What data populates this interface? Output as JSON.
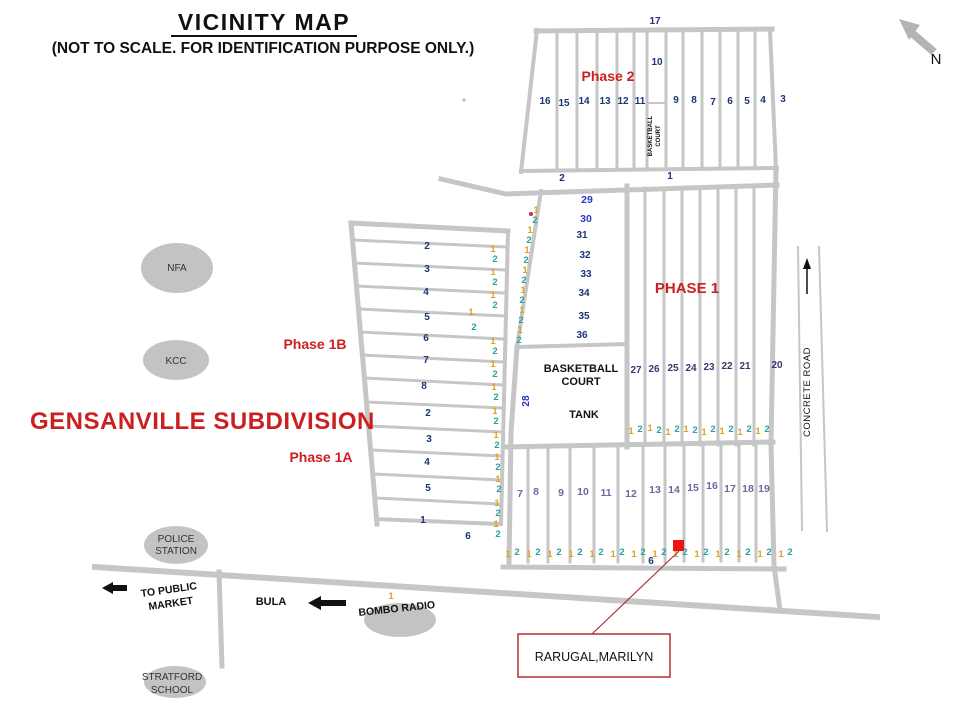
{
  "title": "VICINITY MAP",
  "subtitle": "(NOT TO SCALE. FOR IDENTIFICATION PURPOSE ONLY.)",
  "subdivision": "GENSANVILLE SUBDIVISION",
  "compass": {
    "north": "N"
  },
  "phases": {
    "phase2": "Phase 2",
    "phase1": "PHASE 1",
    "phase1b": "Phase 1B",
    "phase1a": "Phase 1A"
  },
  "landmarks": {
    "nfa": "NFA",
    "kcc": "KCC",
    "police_line1": "POLICE",
    "police_line2": "STATION",
    "stratford_line1": "STRATFORD",
    "stratford_line2": "SCHOOL",
    "bombo_radio": "BOMBO RADIO"
  },
  "roads": {
    "concrete_road": "CONCRETE ROAD",
    "bula": "BULA",
    "to_public_market_line1": "TO PUBLIC",
    "to_public_market_line2": "MARKET"
  },
  "facilities": {
    "bb_small_line1": "BASKETBALL",
    "bb_small_line2": "COURT",
    "bb_line1": "BASKETBALL",
    "bb_line2": "COURT",
    "tank": "TANK",
    "lot28": "28"
  },
  "highlight": {
    "owner": "RARUGAL,MARILYN"
  },
  "colors": {
    "road_gray": "#c6c6c6",
    "lot_navy": "#1c3577",
    "lot_blue": "#2a35cc",
    "lot_slate": "#6a6a9c",
    "lot_dark_navy": "#38386e",
    "lot_orange": "#e2a221",
    "lot_teal": "#2f9fa0",
    "label_red": "#cc2020",
    "marker_red": "#ee1212"
  },
  "markers": {
    "phase2": [
      {
        "t": "17",
        "x": 655,
        "y": 24,
        "c": "n-nv"
      },
      {
        "t": "10",
        "x": 657,
        "y": 65,
        "c": "n-nv"
      },
      {
        "t": "16",
        "x": 545,
        "y": 104,
        "c": "n-nv"
      },
      {
        "t": "15",
        "x": 564,
        "y": 106,
        "c": "n-nv"
      },
      {
        "t": "14",
        "x": 584,
        "y": 104,
        "c": "n-nv"
      },
      {
        "t": "13",
        "x": 605,
        "y": 104,
        "c": "n-nv"
      },
      {
        "t": "12",
        "x": 623,
        "y": 104,
        "c": "n-nv"
      },
      {
        "t": "11",
        "x": 640,
        "y": 104,
        "c": "n-nv"
      },
      {
        "t": "9",
        "x": 676,
        "y": 103,
        "c": "n-nv"
      },
      {
        "t": "8",
        "x": 694,
        "y": 103,
        "c": "n-nv"
      },
      {
        "t": "7",
        "x": 713,
        "y": 105,
        "c": "n-nv"
      },
      {
        "t": "6",
        "x": 730,
        "y": 104,
        "c": "n-nv"
      },
      {
        "t": "5",
        "x": 747,
        "y": 104,
        "c": "n-nv"
      },
      {
        "t": "4",
        "x": 763,
        "y": 103,
        "c": "n-nv"
      },
      {
        "t": "3",
        "x": 783,
        "y": 102,
        "c": "n-nv"
      },
      {
        "t": "2",
        "x": 562,
        "y": 181,
        "c": "n-nv"
      },
      {
        "t": "1",
        "x": 670,
        "y": 179,
        "c": "n-nv"
      }
    ],
    "block2936": [
      {
        "t": "29",
        "x": 587,
        "y": 203,
        "c": "n-bl"
      },
      {
        "t": "30",
        "x": 586,
        "y": 222,
        "c": "n-bl"
      },
      {
        "t": "31",
        "x": 582,
        "y": 238,
        "c": "n-nv"
      },
      {
        "t": "32",
        "x": 585,
        "y": 258,
        "c": "n-nv"
      },
      {
        "t": "33",
        "x": 586,
        "y": 277,
        "c": "n-nv"
      },
      {
        "t": "34",
        "x": 584,
        "y": 296,
        "c": "n-nv"
      },
      {
        "t": "35",
        "x": 584,
        "y": 319,
        "c": "n-nv"
      },
      {
        "t": "36",
        "x": 582,
        "y": 338,
        "c": "n-nv"
      },
      {
        "t": "1",
        "x": 536,
        "y": 213,
        "c": "n-or"
      },
      {
        "t": "2",
        "x": 535,
        "y": 223,
        "c": "n-tl"
      },
      {
        "t": "1",
        "x": 530,
        "y": 233,
        "c": "n-or"
      },
      {
        "t": "2",
        "x": 529,
        "y": 243,
        "c": "n-tl"
      },
      {
        "t": "1",
        "x": 527,
        "y": 253,
        "c": "n-or"
      },
      {
        "t": "2",
        "x": 526,
        "y": 263,
        "c": "n-tl"
      },
      {
        "t": "1",
        "x": 525,
        "y": 273,
        "c": "n-or"
      },
      {
        "t": "2",
        "x": 524,
        "y": 283,
        "c": "n-tl"
      },
      {
        "t": "1",
        "x": 523,
        "y": 293,
        "c": "n-or"
      },
      {
        "t": "2",
        "x": 522,
        "y": 303,
        "c": "n-tl"
      },
      {
        "t": "1",
        "x": 522,
        "y": 313,
        "c": "n-or"
      },
      {
        "t": "2",
        "x": 521,
        "y": 323,
        "c": "n-tl"
      },
      {
        "t": "1",
        "x": 520,
        "y": 333,
        "c": "n-or"
      },
      {
        "t": "2",
        "x": 519,
        "y": 343,
        "c": "n-tl"
      }
    ],
    "leftblock": [
      {
        "t": "2",
        "x": 427,
        "y": 249,
        "c": "n-nv"
      },
      {
        "t": "3",
        "x": 427,
        "y": 272,
        "c": "n-nv"
      },
      {
        "t": "4",
        "x": 426,
        "y": 295,
        "c": "n-nv"
      },
      {
        "t": "5",
        "x": 427,
        "y": 320,
        "c": "n-nv"
      },
      {
        "t": "6",
        "x": 426,
        "y": 341,
        "c": "n-nv"
      },
      {
        "t": "7",
        "x": 426,
        "y": 363,
        "c": "n-nv"
      },
      {
        "t": "8",
        "x": 424,
        "y": 389,
        "c": "n-nv"
      },
      {
        "t": "2",
        "x": 428,
        "y": 416,
        "c": "n-nv"
      },
      {
        "t": "3",
        "x": 429,
        "y": 442,
        "c": "n-nv"
      },
      {
        "t": "4",
        "x": 427,
        "y": 465,
        "c": "n-nv"
      },
      {
        "t": "5",
        "x": 428,
        "y": 491,
        "c": "n-nv"
      },
      {
        "t": "1",
        "x": 423,
        "y": 523,
        "c": "n-nv"
      },
      {
        "t": "6",
        "x": 468,
        "y": 539,
        "c": "n-nv"
      },
      {
        "t": "1",
        "x": 493,
        "y": 252,
        "c": "n-or"
      },
      {
        "t": "2",
        "x": 495,
        "y": 262,
        "c": "n-tl"
      },
      {
        "t": "1",
        "x": 493,
        "y": 275,
        "c": "n-or"
      },
      {
        "t": "2",
        "x": 495,
        "y": 285,
        "c": "n-tl"
      },
      {
        "t": "1",
        "x": 493,
        "y": 298,
        "c": "n-or"
      },
      {
        "t": "2",
        "x": 495,
        "y": 308,
        "c": "n-tl"
      },
      {
        "t": "1",
        "x": 471,
        "y": 315,
        "c": "n-or"
      },
      {
        "t": "2",
        "x": 474,
        "y": 330,
        "c": "n-tl"
      },
      {
        "t": "1",
        "x": 493,
        "y": 344,
        "c": "n-or"
      },
      {
        "t": "2",
        "x": 495,
        "y": 354,
        "c": "n-tl"
      },
      {
        "t": "1",
        "x": 493,
        "y": 367,
        "c": "n-or"
      },
      {
        "t": "2",
        "x": 495,
        "y": 377,
        "c": "n-tl"
      },
      {
        "t": "1",
        "x": 494,
        "y": 390,
        "c": "n-or"
      },
      {
        "t": "2",
        "x": 496,
        "y": 400,
        "c": "n-tl"
      },
      {
        "t": "1",
        "x": 495,
        "y": 414,
        "c": "n-or"
      },
      {
        "t": "2",
        "x": 496,
        "y": 424,
        "c": "n-tl"
      },
      {
        "t": "1",
        "x": 496,
        "y": 438,
        "c": "n-or"
      },
      {
        "t": "2",
        "x": 497,
        "y": 448,
        "c": "n-tl"
      },
      {
        "t": "1",
        "x": 497,
        "y": 460,
        "c": "n-or"
      },
      {
        "t": "2",
        "x": 498,
        "y": 470,
        "c": "n-tl"
      },
      {
        "t": "1",
        "x": 498,
        "y": 482,
        "c": "n-or"
      },
      {
        "t": "2",
        "x": 499,
        "y": 492,
        "c": "n-tl"
      },
      {
        "t": "1",
        "x": 497,
        "y": 506,
        "c": "n-or"
      },
      {
        "t": "2",
        "x": 498,
        "y": 516,
        "c": "n-tl"
      },
      {
        "t": "1",
        "x": 496,
        "y": 527,
        "c": "n-or"
      },
      {
        "t": "2",
        "x": 498,
        "y": 537,
        "c": "n-tl"
      }
    ],
    "block2720": [
      {
        "t": "27",
        "x": 636,
        "y": 373,
        "c": "n-dk"
      },
      {
        "t": "26",
        "x": 654,
        "y": 372,
        "c": "n-dk"
      },
      {
        "t": "25",
        "x": 673,
        "y": 371,
        "c": "n-dk"
      },
      {
        "t": "24",
        "x": 691,
        "y": 371,
        "c": "n-dk"
      },
      {
        "t": "23",
        "x": 709,
        "y": 370,
        "c": "n-dk"
      },
      {
        "t": "22",
        "x": 727,
        "y": 369,
        "c": "n-dk"
      },
      {
        "t": "21",
        "x": 745,
        "y": 369,
        "c": "n-dk"
      },
      {
        "t": "20",
        "x": 777,
        "y": 368,
        "c": "n-dk"
      },
      {
        "t": "1",
        "x": 631,
        "y": 434,
        "c": "n-or"
      },
      {
        "t": "2",
        "x": 640,
        "y": 432,
        "c": "n-tl"
      },
      {
        "t": "1",
        "x": 650,
        "y": 431,
        "c": "n-or"
      },
      {
        "t": "2",
        "x": 659,
        "y": 433,
        "c": "n-tl"
      },
      {
        "t": "1",
        "x": 668,
        "y": 435,
        "c": "n-or"
      },
      {
        "t": "2",
        "x": 677,
        "y": 432,
        "c": "n-tl"
      },
      {
        "t": "1",
        "x": 686,
        "y": 432,
        "c": "n-or"
      },
      {
        "t": "2",
        "x": 695,
        "y": 433,
        "c": "n-tl"
      },
      {
        "t": "1",
        "x": 704,
        "y": 435,
        "c": "n-or"
      },
      {
        "t": "2",
        "x": 713,
        "y": 432,
        "c": "n-tl"
      },
      {
        "t": "1",
        "x": 722,
        "y": 434,
        "c": "n-or"
      },
      {
        "t": "2",
        "x": 731,
        "y": 432,
        "c": "n-tl"
      },
      {
        "t": "1",
        "x": 740,
        "y": 435,
        "c": "n-or"
      },
      {
        "t": "2",
        "x": 749,
        "y": 432,
        "c": "n-tl"
      },
      {
        "t": "1",
        "x": 758,
        "y": 434,
        "c": "n-or"
      },
      {
        "t": "2",
        "x": 767,
        "y": 432,
        "c": "n-tl"
      }
    ],
    "bottomblock": [
      {
        "t": "7",
        "x": 520,
        "y": 497,
        "c": "n-sl"
      },
      {
        "t": "8",
        "x": 536,
        "y": 495,
        "c": "n-sl"
      },
      {
        "t": "9",
        "x": 561,
        "y": 496,
        "c": "n-sl"
      },
      {
        "t": "10",
        "x": 583,
        "y": 495,
        "c": "n-sl"
      },
      {
        "t": "11",
        "x": 606,
        "y": 496,
        "c": "n-sl"
      },
      {
        "t": "12",
        "x": 631,
        "y": 497,
        "c": "n-sl"
      },
      {
        "t": "13",
        "x": 655,
        "y": 493,
        "c": "n-sl"
      },
      {
        "t": "14",
        "x": 674,
        "y": 493,
        "c": "n-sl"
      },
      {
        "t": "15",
        "x": 693,
        "y": 491,
        "c": "n-sl"
      },
      {
        "t": "16",
        "x": 712,
        "y": 489,
        "c": "n-sl"
      },
      {
        "t": "17",
        "x": 730,
        "y": 492,
        "c": "n-sl"
      },
      {
        "t": "18",
        "x": 748,
        "y": 492,
        "c": "n-sl"
      },
      {
        "t": "19",
        "x": 764,
        "y": 492,
        "c": "n-sl"
      },
      {
        "t": "6",
        "x": 651,
        "y": 564,
        "c": "n-nv"
      },
      {
        "t": "1",
        "x": 508,
        "y": 557,
        "c": "n-or"
      },
      {
        "t": "2",
        "x": 517,
        "y": 555,
        "c": "n-tl"
      },
      {
        "t": "1",
        "x": 529,
        "y": 557,
        "c": "n-or"
      },
      {
        "t": "2",
        "x": 538,
        "y": 555,
        "c": "n-tl"
      },
      {
        "t": "1",
        "x": 550,
        "y": 557,
        "c": "n-or"
      },
      {
        "t": "2",
        "x": 559,
        "y": 555,
        "c": "n-tl"
      },
      {
        "t": "1",
        "x": 571,
        "y": 557,
        "c": "n-or"
      },
      {
        "t": "2",
        "x": 580,
        "y": 555,
        "c": "n-tl"
      },
      {
        "t": "1",
        "x": 592,
        "y": 557,
        "c": "n-or"
      },
      {
        "t": "2",
        "x": 601,
        "y": 555,
        "c": "n-tl"
      },
      {
        "t": "1",
        "x": 613,
        "y": 557,
        "c": "n-or"
      },
      {
        "t": "2",
        "x": 622,
        "y": 555,
        "c": "n-tl"
      },
      {
        "t": "1",
        "x": 634,
        "y": 557,
        "c": "n-or"
      },
      {
        "t": "2",
        "x": 643,
        "y": 555,
        "c": "n-tl"
      },
      {
        "t": "1",
        "x": 655,
        "y": 557,
        "c": "n-or"
      },
      {
        "t": "2",
        "x": 664,
        "y": 555,
        "c": "n-tl"
      },
      {
        "t": "1",
        "x": 676,
        "y": 557,
        "c": "n-or"
      },
      {
        "t": "2",
        "x": 685,
        "y": 555,
        "c": "n-tl"
      },
      {
        "t": "1",
        "x": 697,
        "y": 557,
        "c": "n-or"
      },
      {
        "t": "2",
        "x": 706,
        "y": 555,
        "c": "n-tl"
      },
      {
        "t": "1",
        "x": 718,
        "y": 557,
        "c": "n-or"
      },
      {
        "t": "2",
        "x": 727,
        "y": 555,
        "c": "n-tl"
      },
      {
        "t": "1",
        "x": 739,
        "y": 557,
        "c": "n-or"
      },
      {
        "t": "2",
        "x": 748,
        "y": 555,
        "c": "n-tl"
      },
      {
        "t": "1",
        "x": 760,
        "y": 557,
        "c": "n-or"
      },
      {
        "t": "2",
        "x": 769,
        "y": 555,
        "c": "n-tl"
      },
      {
        "t": "1",
        "x": 781,
        "y": 557,
        "c": "n-or"
      },
      {
        "t": "2",
        "x": 790,
        "y": 555,
        "c": "n-tl"
      }
    ],
    "stray": [
      {
        "t": "1",
        "x": 391,
        "y": 599,
        "c": "n-or"
      }
    ]
  }
}
